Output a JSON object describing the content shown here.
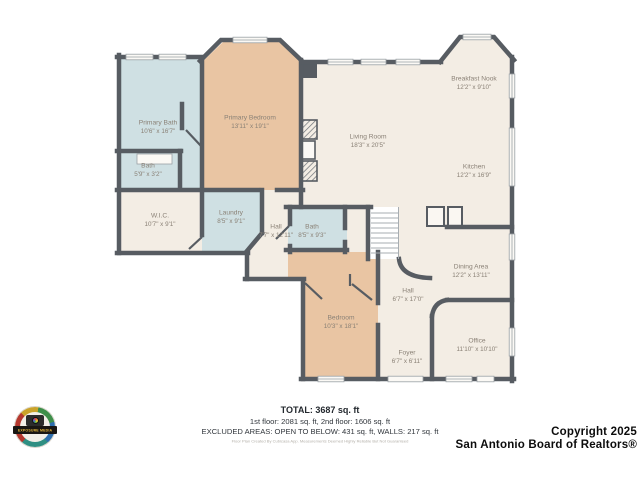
{
  "palette": {
    "wall": "#575c62",
    "floor_cream": "#f3ede4",
    "floor_blue": "#cfe0e3",
    "floor_peach": "#e9c5a3",
    "stairs": "#ffffff",
    "label_text": "#8a8176"
  },
  "rooms": [
    {
      "name": "Primary Bath",
      "dims": "10'6\" x 16'7\""
    },
    {
      "name": "Bath",
      "dims": "5'9\" x 3'2\""
    },
    {
      "name": "Primary Bedroom",
      "dims": "13'11\" x 19'1\""
    },
    {
      "name": "W.I.C.",
      "dims": "10'7\" x 9'1\""
    },
    {
      "name": "Laundry",
      "dims": "8'5\" x 9'1\""
    },
    {
      "name": "Hall",
      "dims": "7'7\" x 12'11\""
    },
    {
      "name": "Bath",
      "dims": "8'5\" x 9'3\""
    },
    {
      "name": "Living Room",
      "dims": "18'3\" x 20'5\""
    },
    {
      "name": "Breakfast Nook",
      "dims": "12'2\" x 9'10\""
    },
    {
      "name": "Kitchen",
      "dims": "12'2\" x 16'9\""
    },
    {
      "name": "Dining Area",
      "dims": "12'2\" x 13'11\""
    },
    {
      "name": "Hall",
      "dims": "6'7\" x 17'0\""
    },
    {
      "name": "Office",
      "dims": "11'10\" x 10'10\""
    },
    {
      "name": "Foyer",
      "dims": "6'7\" x 6'11\""
    },
    {
      "name": "Bedroom",
      "dims": "10'3\" x 18'1\""
    }
  ],
  "footer": {
    "total": "TOTAL: 3687 sq. ft",
    "floors": "1st floor: 2081 sq. ft, 2nd floor: 1606 sq. ft",
    "excluded": "EXCLUDED AREAS: OPEN TO BELOW: 431 sq. ft, WALLS: 217 sq. ft",
    "disclaimer": "Floor Plan Created By Cubicasa App. Measurements Deemed Highly Reliable But Not Guaranteed"
  },
  "copyright": {
    "line1": "Copyright 2025",
    "line2": "San Antonio Board of Realtors®"
  },
  "logo": {
    "label": "EXPOSURE MEDIA"
  }
}
